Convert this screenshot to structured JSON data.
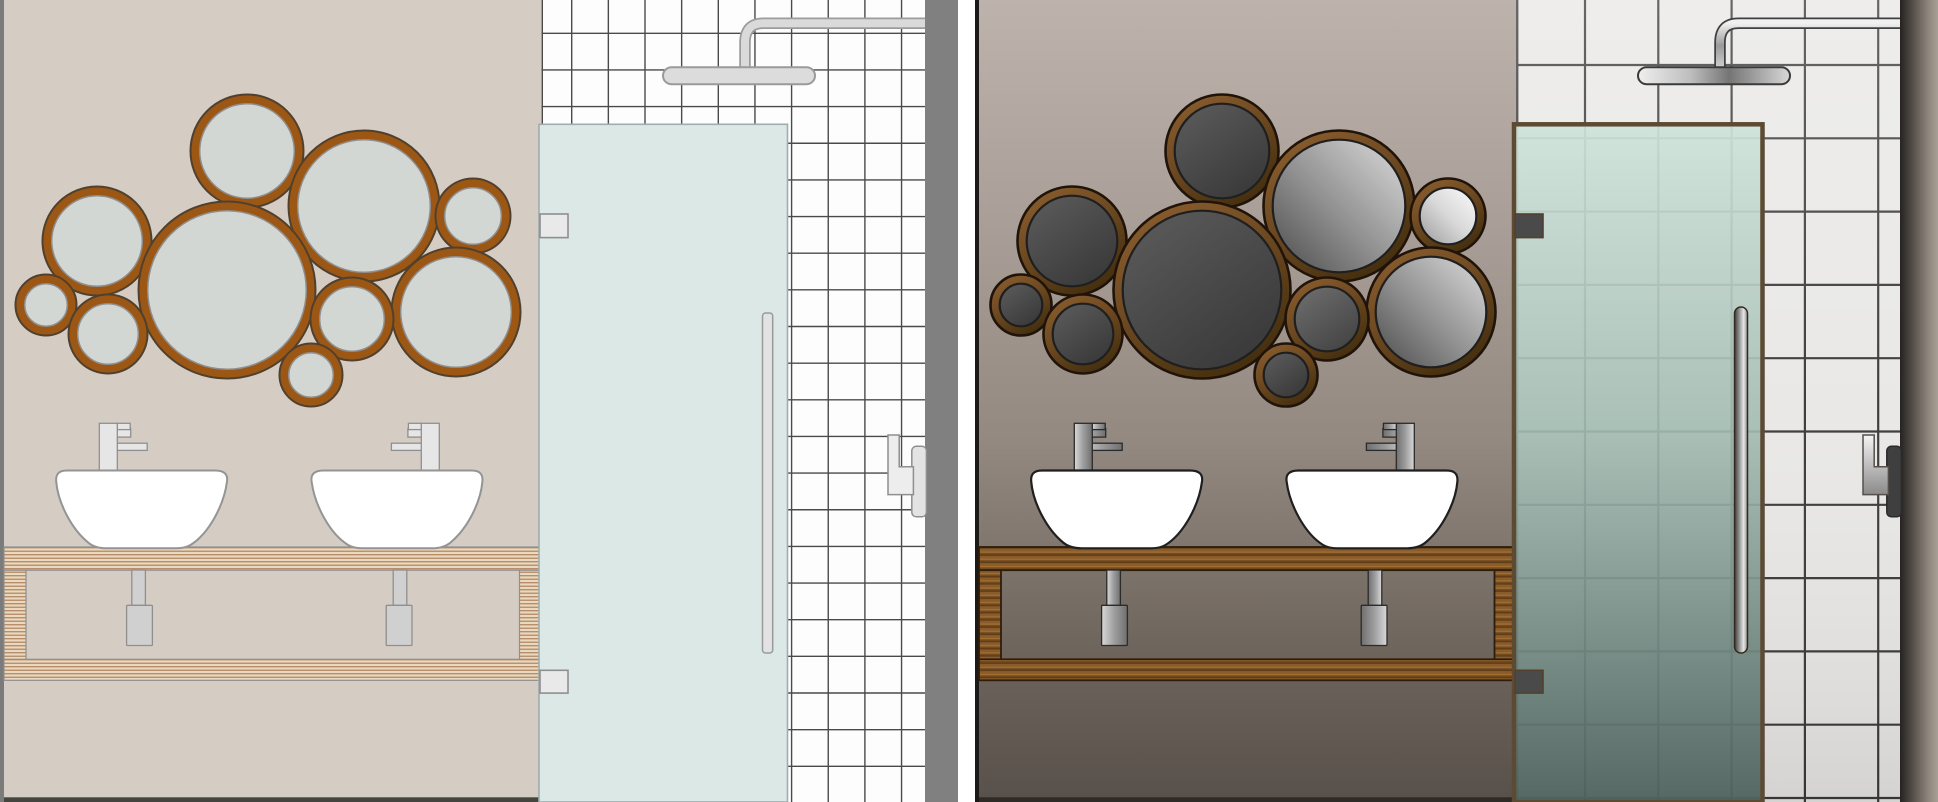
{
  "scene": {
    "description": "Side-by-side comparison of the same vector bathroom interior: left panel rendered in a flat pastel style, right panel rendered in a shaded realistic style. Each panel shows a bubble-mirror cluster, two vessel sinks with faucets on an open wooden vanity, a tiled shower wall with rain shower head, a glass shower door and a towel hook.",
    "background": "#ffffff"
  },
  "panels": [
    {
      "id": "p1",
      "label": "flat-style bathroom panel",
      "border": "#7b7b7b",
      "strip": "#808080",
      "strip_w": 33,
      "wall": {
        "fill": "#d5cdc4",
        "baseboard": "#45453f"
      },
      "tiles": {
        "fill": "#fdfdfd",
        "grout": "#4a4a4a",
        "grout_width": 1.4,
        "first_v": 571.7,
        "first_h": 33.3,
        "step": 36.65,
        "overlay": null
      },
      "mirror": {
        "frame": "#9c5715",
        "frame_outline": "#50402e",
        "outline_w": 2,
        "glass_outline": "#8e8e8e",
        "glass_outline_w": 1.5,
        "glass": [
          "#d3d7d3",
          "#d3d7d3",
          "#d3d7d3",
          "#d3d7d3",
          "#d3d7d3",
          "#d3d7d3",
          "#d3d7d3",
          "#d3d7d3",
          "#d3d7d3",
          "#d3d7d3"
        ]
      },
      "shower": {
        "head": "#dcdcdc",
        "outline": "#9a9a9a",
        "arm_outer": "#9c9c9c",
        "arm_inner": "#dadada"
      },
      "sink": {
        "fill": "#ffffff",
        "outline": "#949494",
        "outline_w": 2
      },
      "faucet": {
        "fill": "#e6e6e6",
        "outline": "#8f8f8f"
      },
      "pipes": {
        "fill": "#d0d0d0",
        "outline": "#8f8f8f"
      },
      "vanity": {
        "variant": "plywood",
        "base": "#ead9c0",
        "stripe": "#b28660",
        "outline": "#8f8f8f",
        "outline_w": 1.2
      },
      "door": {
        "glass": "#dbe8e6",
        "frame": "#9fadad",
        "frame_w": 1.6,
        "hinge": "#e9e9e9",
        "hinge_outline": "#8f8f8f",
        "handle": [
          762.5,
          313,
          10.2,
          340,
          3
        ],
        "handle_fill": "#e2e2e2",
        "handle_outline": "#9a9a9a"
      },
      "hook": {
        "metal": "#ededed",
        "outline": "#8f8f8f",
        "plate": "#e3e3e3",
        "plate_outline": "#8f8f8f"
      },
      "gradients": {}
    },
    {
      "id": "p2",
      "label": "shaded-style bathroom panel",
      "border": "#1c1a18",
      "strip": "url:stripG",
      "strip_w": 38,
      "wall": {
        "fill": "url:wall",
        "baseboard": "#2e2a26"
      },
      "tiles": {
        "fill": "#e9e8e6",
        "grout": "#3b3b3b",
        "grout_width": 2.2,
        "first_v": 610,
        "first_h": 65,
        "step": 73.3,
        "overlay": "url:tileShade"
      },
      "mirror": {
        "frame": "url:mframe",
        "frame_outline": "#20140a",
        "outline_w": 2.6,
        "glass_outline": "#1f1f1f",
        "glass_outline_w": 2.2,
        "glass": [
          "url:mdark",
          "url:mbright",
          "url:mwhite",
          "url:mdark",
          "url:mdark",
          "url:mbright",
          "url:mdark",
          "url:mdark2",
          "url:mdark",
          "url:mdark"
        ]
      },
      "shower": {
        "head": "url:chromeH",
        "outline": "#3a3a3a",
        "arm_outer": "#3f3f3f",
        "arm_inner": "url:armC"
      },
      "sink": {
        "fill": "#ffffff",
        "outline": "#1f1f1f",
        "outline_w": 2.2
      },
      "faucet": {
        "fill": "url:chromeV",
        "outline": "#2b2b2b"
      },
      "pipes": {
        "fill": "url:chromeV",
        "outline": "#2b2b2b"
      },
      "vanity": {
        "variant": "wood",
        "base": "#8a5c2c",
        "dark": "#5f3d18",
        "light": "#a3702f",
        "dark2": "#734a1d",
        "outline": "#2d1d0d",
        "outline_w": 1.8
      },
      "door": {
        "glass": "url:doorGlass",
        "frame": "#5d4a33",
        "frame_w": 4.5,
        "hinge": "#4a4a4a",
        "hinge_outline": "#53412c",
        "handle": [
          759.5,
          307,
          13,
          346,
          6.5
        ],
        "handle_fill": "url:handleC",
        "handle_outline": "#332a1d"
      },
      "hook": {
        "metal": "url:hookC",
        "outline": "#55504b",
        "plate": "#3f3f3f",
        "plate_outline": "#2a2a2a"
      },
      "gradients": {
        "wall": {
          "dir": [
            0,
            0,
            0,
            1
          ],
          "stops": [
            [
              0,
              "#bdb3ac"
            ],
            [
              0.3,
              "#a89d96"
            ],
            [
              0.55,
              "#938980"
            ],
            [
              0.8,
              "#6f665e"
            ],
            [
              1,
              "#58504a"
            ]
          ]
        },
        "mdark": {
          "dir": [
            0,
            0,
            0.7,
            1
          ],
          "stops": [
            [
              0,
              "#5d5d5d"
            ],
            [
              1,
              "#3a3a3a"
            ]
          ]
        },
        "mdark2": {
          "dir": [
            0,
            0,
            0.7,
            1
          ],
          "stops": [
            [
              0,
              "#707070"
            ],
            [
              1,
              "#454545"
            ]
          ]
        },
        "mbright": {
          "dir": [
            0,
            1,
            1,
            0
          ],
          "stops": [
            [
              0,
              "#4b4b4b"
            ],
            [
              0.45,
              "#8f8f8f"
            ],
            [
              1,
              "#dcdcdc"
            ]
          ]
        },
        "mwhite": {
          "dir": [
            0,
            1,
            1,
            0
          ],
          "stops": [
            [
              0,
              "#9b9b9b"
            ],
            [
              0.5,
              "#d8d8d8"
            ],
            [
              1,
              "#fcfcfc"
            ]
          ]
        },
        "mframe": {
          "dir": [
            0,
            0,
            0.6,
            1
          ],
          "stops": [
            [
              0,
              "#8f6130"
            ],
            [
              0.5,
              "#6f4a22"
            ],
            [
              1,
              "#46300f"
            ]
          ]
        },
        "chromeH": {
          "dir": [
            0,
            0,
            1,
            0
          ],
          "stops": [
            [
              0,
              "#efefef"
            ],
            [
              0.35,
              "#bdbdbd"
            ],
            [
              0.6,
              "#757575"
            ],
            [
              1,
              "#d8d8d8"
            ]
          ]
        },
        "chromeV": {
          "dir": [
            0,
            0,
            1,
            0
          ],
          "stops": [
            [
              0,
              "#d9d9d9"
            ],
            [
              0.5,
              "#9d9d9d"
            ],
            [
              1,
              "#6f6f6f"
            ]
          ]
        },
        "armC": {
          "dir": [
            0,
            0,
            0,
            1
          ],
          "stops": [
            [
              0,
              "#f0f0f0"
            ],
            [
              0.5,
              "#9a9a9a"
            ],
            [
              1,
              "#cfcfcf"
            ]
          ]
        },
        "doorGlass": {
          "dir": [
            0,
            0,
            0,
            1
          ],
          "stops": [
            [
              0,
              "#cfe3da",
              0.92
            ],
            [
              0.45,
              "#a3bcb2",
              0.9
            ],
            [
              1,
              "#4f635f",
              0.95
            ]
          ]
        },
        "handleC": {
          "dir": [
            0,
            0,
            1,
            0
          ],
          "stops": [
            [
              0,
              "#3a3a3a"
            ],
            [
              0.4,
              "#9a9a9a"
            ],
            [
              0.7,
              "#e6e6e6"
            ],
            [
              1,
              "#8f8f8f"
            ]
          ]
        },
        "stripG": {
          "dir": [
            0,
            0,
            1,
            0
          ],
          "stops": [
            [
              0,
              "#262220"
            ],
            [
              0.75,
              "#8f867d"
            ],
            [
              1,
              "#a89f96"
            ]
          ]
        },
        "hookC": {
          "dir": [
            0,
            0,
            0,
            1
          ],
          "stops": [
            [
              0,
              "#f4f4f4"
            ],
            [
              1,
              "#8a8a8a"
            ]
          ]
        },
        "tileShade": {
          "dir": [
            0,
            0,
            0,
            1
          ],
          "stops": [
            [
              0,
              "#ffffff",
              0.22
            ],
            [
              0.5,
              "#ffffff",
              0.02
            ],
            [
              1,
              "#000000",
              0.09
            ]
          ]
        }
      }
    }
  ]
}
